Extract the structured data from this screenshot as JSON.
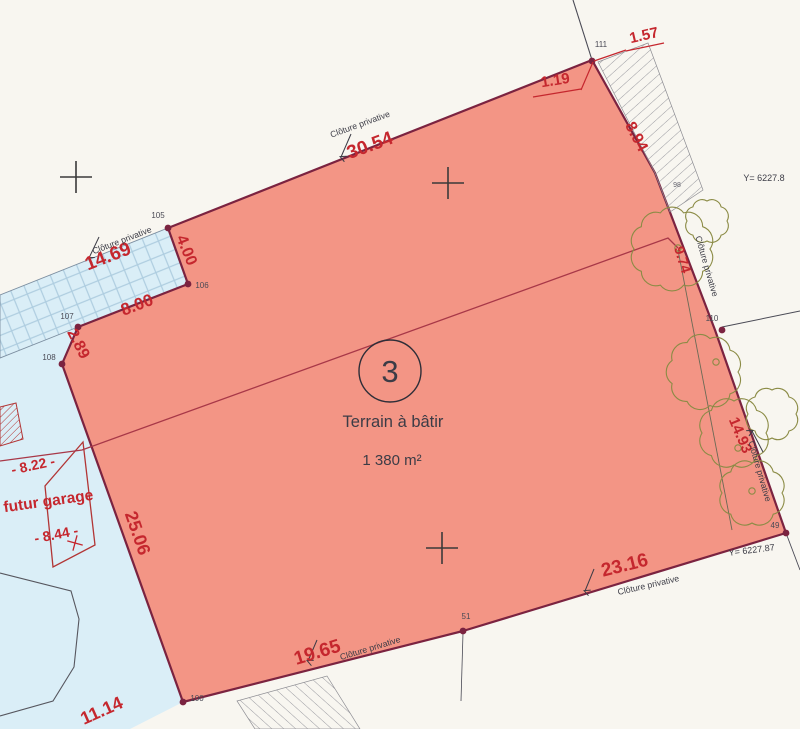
{
  "meta": {
    "parcel_number": "3",
    "parcel_type": "Terrain à bâtir",
    "parcel_area": "1 380 m²"
  },
  "colors": {
    "red": "#c5272e",
    "ink": "#3c3c46",
    "soft": "#63636d",
    "parcel_fill": "#f39585",
    "parcel_edge": "#7b2340",
    "blue_fill": "#daeef7",
    "blue_hatch": "#aecde0",
    "tree": "#8b8b45",
    "garage_red": "#b23535",
    "utility_red": "#a83848",
    "line_dark": "#4a4a55"
  },
  "measurements": [
    {
      "name": "dim-30-54",
      "text": "30.54",
      "x": 372,
      "y": 151,
      "rot": -20,
      "size": 19
    },
    {
      "name": "dim-1-19",
      "text": "1.19",
      "x": 556,
      "y": 85,
      "rot": -9,
      "size": 15
    },
    {
      "name": "dim-1-57",
      "text": "1.57",
      "x": 645,
      "y": 40,
      "rot": -13,
      "size": 15
    },
    {
      "name": "dim-8-94",
      "text": "8.94",
      "x": 632,
      "y": 139,
      "rot": 62,
      "size": 16
    },
    {
      "name": "dim-14-69",
      "text": "14.69",
      "x": 110,
      "y": 262,
      "rot": -21,
      "size": 19
    },
    {
      "name": "dim-4-00",
      "text": "4.00",
      "x": 182,
      "y": 252,
      "rot": 68,
      "size": 16
    },
    {
      "name": "dim-8-00",
      "text": "8.00",
      "x": 139,
      "y": 310,
      "rot": -21,
      "size": 17
    },
    {
      "name": "dim-2-89",
      "text": "2.89",
      "x": 74,
      "y": 346,
      "rot": 63,
      "size": 16
    },
    {
      "name": "dim-25-06",
      "text": "25.06",
      "x": 132,
      "y": 535,
      "rot": 71,
      "size": 18
    },
    {
      "name": "dim-11-14",
      "text": "11.14",
      "x": 104,
      "y": 716,
      "rot": -24,
      "size": 18
    },
    {
      "name": "dim-19-65",
      "text": "19.65",
      "x": 319,
      "y": 658,
      "rot": -17,
      "size": 19
    },
    {
      "name": "dim-23-16",
      "text": "23.16",
      "x": 626,
      "y": 571,
      "rot": -14,
      "size": 19
    },
    {
      "name": "dim-9-74",
      "text": "9.74",
      "x": 678,
      "y": 261,
      "rot": 73,
      "size": 14
    },
    {
      "name": "dim-14-93",
      "text": "14.93",
      "x": 736,
      "y": 437,
      "rot": 67,
      "size": 15
    },
    {
      "name": "dim-8-22",
      "text": "- 8.22 -",
      "x": 34,
      "y": 470,
      "rot": -12,
      "size": 14
    },
    {
      "name": "futur-garage-label",
      "text": "futur garage",
      "x": 49,
      "y": 506,
      "rot": -8,
      "size": 15.5
    },
    {
      "name": "dim-8-44",
      "text": "- 8.44 -",
      "x": 57,
      "y": 539,
      "rot": -11,
      "size": 14
    }
  ],
  "fence": {
    "text": "Clôture privative",
    "items": [
      {
        "name": "fence-top",
        "x": 361,
        "y": 127,
        "rot": -20
      },
      {
        "name": "fence-left",
        "x": 123,
        "y": 243,
        "rot": -21
      },
      {
        "name": "fence-right-upper",
        "x": 704,
        "y": 267,
        "rot": 74
      },
      {
        "name": "fence-right-lower",
        "x": 757,
        "y": 472,
        "rot": 74
      },
      {
        "name": "fence-bottom-right",
        "x": 649,
        "y": 588,
        "rot": -13
      },
      {
        "name": "fence-bottom-left",
        "x": 371,
        "y": 651,
        "rot": -17
      }
    ]
  },
  "coord_labels": [
    {
      "name": "y-coord-top",
      "text": "Y= 6227.8",
      "x": 764,
      "y": 181,
      "rot": 0,
      "size": 9
    },
    {
      "name": "y-coord-bottom",
      "text": "Y= 6227.87",
      "x": 752,
      "y": 553,
      "rot": -7,
      "size": 9
    }
  ],
  "extra_labels": [
    {
      "name": "point-label-98",
      "text": "98",
      "x": 677,
      "y": 187,
      "rot": 0,
      "size": 7
    }
  ],
  "survey_points": [
    {
      "id": "111",
      "x": 592,
      "y": 61,
      "lx": 601,
      "ly": 47
    },
    {
      "id": "105",
      "x": 168,
      "y": 228,
      "lx": 158,
      "ly": 218
    },
    {
      "id": "106",
      "x": 188,
      "y": 284,
      "lx": 202,
      "ly": 288
    },
    {
      "id": "107",
      "x": 78,
      "y": 327,
      "lx": 67,
      "ly": 319
    },
    {
      "id": "108",
      "x": 62,
      "y": 364,
      "lx": 49,
      "ly": 360
    },
    {
      "id": "100",
      "x": 183,
      "y": 702,
      "lx": 197,
      "ly": 701
    },
    {
      "id": "51",
      "x": 463,
      "y": 631,
      "lx": 466,
      "ly": 619
    },
    {
      "id": "49",
      "x": 786,
      "y": 533,
      "lx": 775,
      "ly": 528
    },
    {
      "id": "110",
      "x": 722,
      "y": 330,
      "lx": 712,
      "ly": 321
    }
  ],
  "crosses": [
    [
      76,
      177
    ],
    [
      448,
      183
    ],
    [
      442,
      548
    ]
  ],
  "red_tick": [
    75,
    543
  ],
  "arrows": [
    {
      "x1": 351,
      "y1": 134,
      "x2": 341,
      "y2": 157
    },
    {
      "x1": 99,
      "y1": 237,
      "x2": 89,
      "y2": 258
    },
    {
      "x1": 317,
      "y1": 640,
      "x2": 308,
      "y2": 661
    },
    {
      "x1": 594,
      "y1": 569,
      "x2": 585,
      "y2": 591
    },
    {
      "x1": 763,
      "y1": 452,
      "x2": 752,
      "y2": 431
    }
  ],
  "red_segments": [
    [
      533,
      97,
      581,
      89
    ],
    [
      626,
      51,
      664,
      43
    ],
    [
      581,
      90,
      593,
      62
    ],
    [
      626,
      50,
      594,
      61
    ]
  ],
  "trees": {
    "canopies": [
      {
        "cx": 672,
        "cy": 249,
        "r": 38
      },
      {
        "cx": 704,
        "cy": 372,
        "r": 34
      },
      {
        "cx": 734,
        "cy": 433,
        "r": 32
      },
      {
        "cx": 752,
        "cy": 493,
        "r": 30
      },
      {
        "cx": 707,
        "cy": 221,
        "r": 20
      },
      {
        "cx": 772,
        "cy": 414,
        "r": 24
      }
    ],
    "trunks": [
      [
        678,
        248
      ],
      [
        716,
        362
      ],
      [
        738,
        448
      ],
      [
        752,
        491
      ]
    ],
    "line": [
      678,
      250,
      732,
      530
    ]
  }
}
